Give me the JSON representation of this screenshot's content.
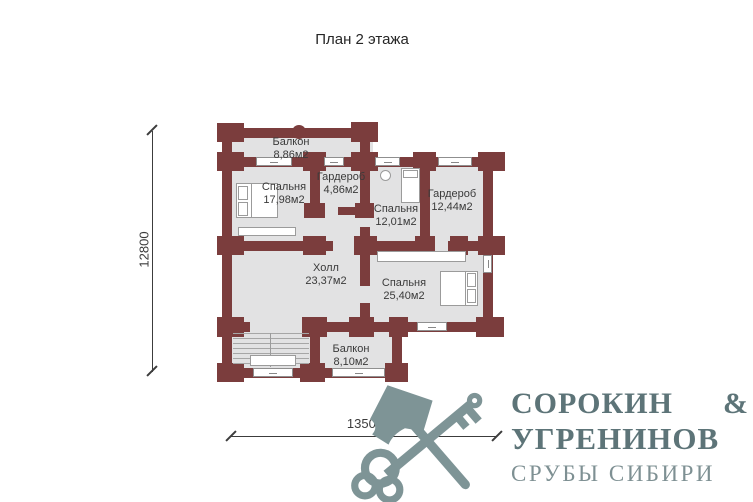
{
  "title": "План 2 этажа",
  "plan": {
    "rooms": [
      {
        "name": "Балкон",
        "area": "8,86м2"
      },
      {
        "name": "Спальня",
        "area": "17,98м2"
      },
      {
        "name": "Гардероб",
        "area": "4,86м2"
      },
      {
        "name": "Спальня",
        "area": "12,01м2"
      },
      {
        "name": "Гардероб",
        "area": "12,44м2"
      },
      {
        "name": "Холл",
        "area": "23,37м2"
      },
      {
        "name": "Спальня",
        "area": "25,40м2"
      },
      {
        "name": "Балкон",
        "area": "8,10м2"
      }
    ],
    "dimensions": {
      "vertical": "12800",
      "horizontal": "13500"
    },
    "colors": {
      "wall": "#7b3d3d",
      "room_fill": "#e2e2e3",
      "window_border": "#8f8f8f",
      "dimension": "#3c3c3c"
    }
  },
  "logo": {
    "name_line1": "СОРОКИН",
    "ampersand": "&",
    "name_line2": "УГРЕНИНОВ",
    "tagline": "СРУБЫ СИБИРИ",
    "icon": "crossed-axe-and-key-icon",
    "colors": {
      "primary_text": "#5d7478",
      "tagline_text": "#7e9093",
      "icon": "#7e9496"
    }
  }
}
